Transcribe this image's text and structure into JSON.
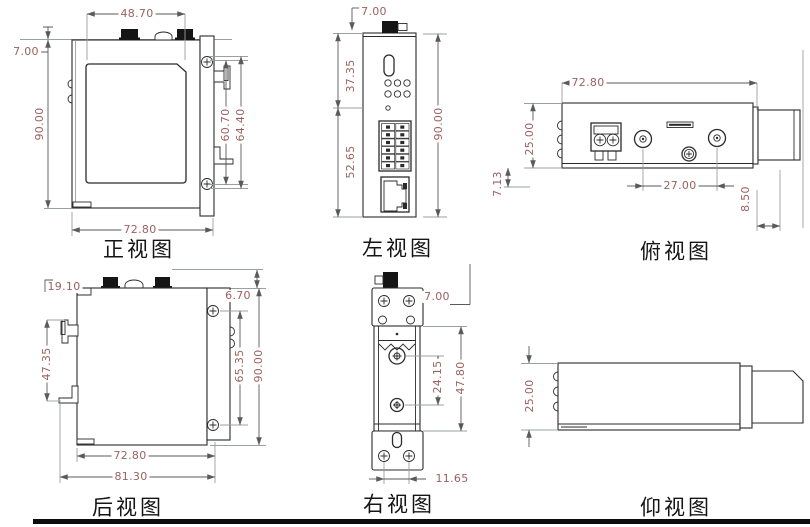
{
  "page": {
    "background": "#ffffff",
    "dim_text_color": "#9b6260",
    "line_color": "#2b2b2b",
    "footer_bar_color": "#0c0c0c"
  },
  "views": {
    "front": {
      "label": "正视图",
      "dims": {
        "span_top": "48.70",
        "offset_top": "7.00",
        "height": "90.00",
        "clip_inner": "60.70",
        "clip_outer": "64.40",
        "width": "72.80"
      }
    },
    "left": {
      "label": "左视图",
      "dims": {
        "offset_top": "7.00",
        "section_upper": "37.35",
        "section_lower": "52.65",
        "height": "90.00"
      }
    },
    "top": {
      "label": "俯视图",
      "dims": {
        "width": "72.80",
        "depth": "25.00",
        "offset_edge": "7.13",
        "antenna_spacing": "27.00",
        "clip_depth": "8.50"
      }
    },
    "back": {
      "label": "后视图",
      "dims": {
        "offset_top": "19.10",
        "rail_span": "47.35",
        "offset_side": "6.70",
        "screw_spacing": "65.35",
        "height": "90.00",
        "width": "72.80",
        "width_overall": "81.30"
      }
    },
    "right": {
      "label": "右视图",
      "dims": {
        "offset_top": "7.00",
        "screw_spacing": "24.15",
        "channel_height": "47.80",
        "hole_offset": "11.65"
      }
    },
    "bottom": {
      "label": "仰视图",
      "dims": {
        "depth": "25.00"
      }
    }
  }
}
